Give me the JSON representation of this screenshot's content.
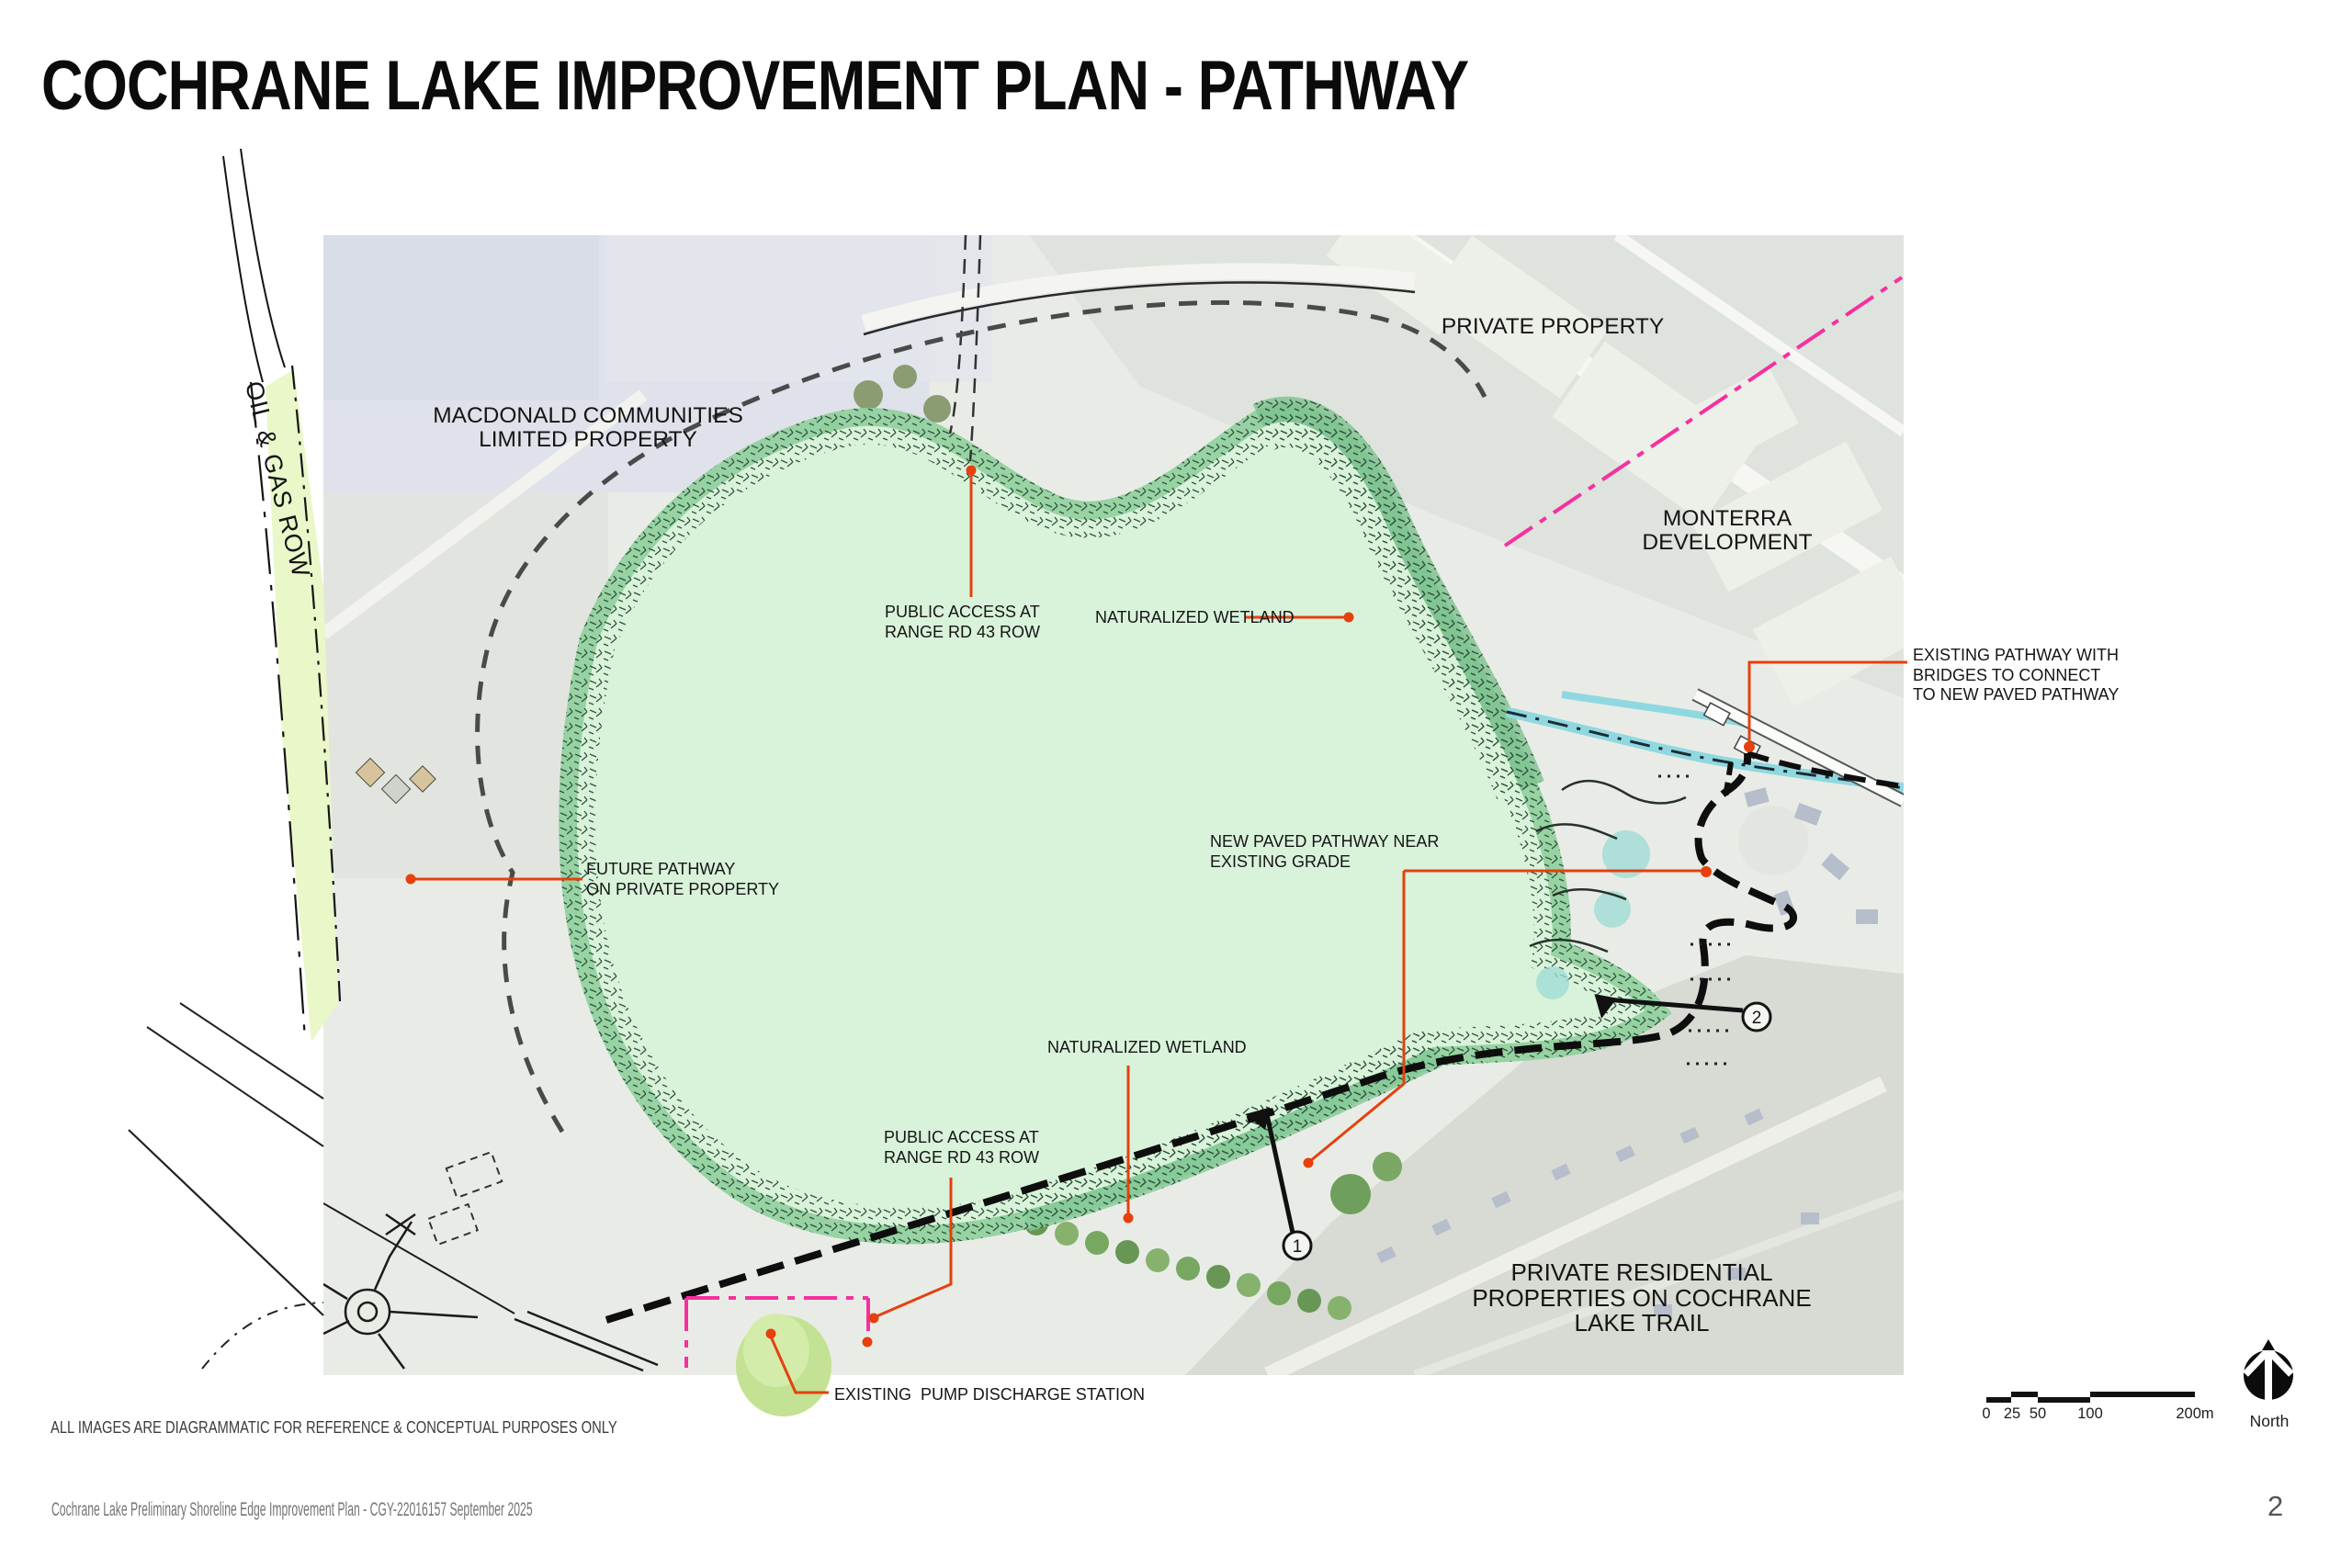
{
  "slide": {
    "title": "COCHRANE LAKE IMPROVEMENT PLAN - PATHWAY",
    "disclaimer": "ALL IMAGES ARE DIAGRAMMATIC FOR REFERENCE & CONCEPTUAL PURPOSES ONLY",
    "footer": "Cochrane Lake Preliminary Shoreline Edge Improvement Plan - CGY-22016157 September 2025",
    "page_number": "2"
  },
  "map": {
    "area_labels": {
      "oil_gas_row": "OIL & GAS ROW",
      "macdonald": "MACDONALD COMMUNITIES\nLIMITED PROPERTY",
      "private_property": "PRIVATE PROPERTY",
      "monterra": "MONTERRA\nDEVELOPMENT",
      "private_residential": "PRIVATE RESIDENTIAL\nPROPERTIES ON COCHRANE\nLAKE TRAIL"
    },
    "annotations": {
      "public_access_north": "PUBLIC ACCESS AT\nRANGE RD 43 ROW",
      "naturalized_wetland_north": "NATURALIZED WETLAND",
      "existing_pathway_bridges": "EXISTING PATHWAY WITH\nBRIDGES TO CONNECT\nTO NEW PAVED PATHWAY",
      "new_paved_pathway": "NEW PAVED PATHWAY NEAR\nEXISTING GRADE",
      "future_pathway": "FUTURE PATHWAY\nON PRIVATE PROPERTY",
      "naturalized_wetland_south": "NATURALIZED WETLAND",
      "public_access_south": "PUBLIC ACCESS AT\nRANGE RD 43 ROW",
      "pump_station": "EXISTING  PUMP DISCHARGE STATION"
    },
    "markers": {
      "marker_1": "1",
      "marker_2": "2"
    }
  },
  "legend": {
    "scale_labels": [
      "0",
      "25",
      "50",
      "100",
      "200m"
    ],
    "north_label": "North"
  },
  "colors": {
    "leader_red": "#E6400F",
    "boundary_pink": "#F5309F",
    "lake_green": "#D9F3DA",
    "wetland_green": "#93D2A0",
    "row_strip_green": "#E9F7C9",
    "stream_blue": "#8FD8E0",
    "path_black": "#0E0E0E",
    "path_gray": "#4A4A4A"
  }
}
